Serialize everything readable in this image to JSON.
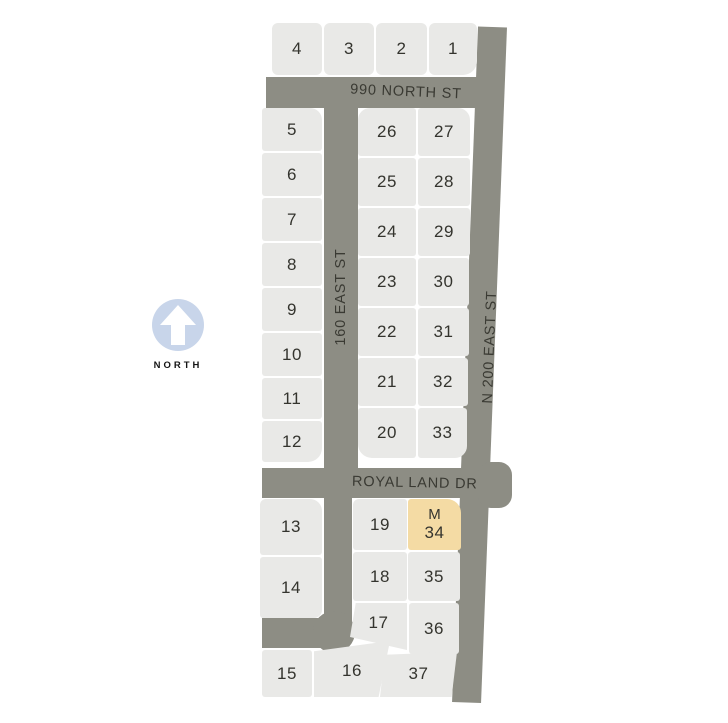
{
  "map": {
    "north_indicator": {
      "label": "NORTH"
    },
    "streets": {
      "north_990": {
        "name": "990 NORTH ST"
      },
      "east_160": {
        "name": "160 EAST ST"
      },
      "east_200": {
        "name": "N 200 EAST ST"
      },
      "royal_land": {
        "name": "ROYAL LAND DR"
      }
    },
    "highlighted_lot": {
      "number": "34",
      "marker": "M"
    },
    "lots": {
      "l1": {
        "number": "1"
      },
      "l2": {
        "number": "2"
      },
      "l3": {
        "number": "3"
      },
      "l4": {
        "number": "4"
      },
      "l5": {
        "number": "5"
      },
      "l6": {
        "number": "6"
      },
      "l7": {
        "number": "7"
      },
      "l8": {
        "number": "8"
      },
      "l9": {
        "number": "9"
      },
      "l10": {
        "number": "10"
      },
      "l11": {
        "number": "11"
      },
      "l12": {
        "number": "12"
      },
      "l13": {
        "number": "13"
      },
      "l14": {
        "number": "14"
      },
      "l15": {
        "number": "15"
      },
      "l16": {
        "number": "16"
      },
      "l17": {
        "number": "17"
      },
      "l18": {
        "number": "18"
      },
      "l19": {
        "number": "19"
      },
      "l20": {
        "number": "20"
      },
      "l21": {
        "number": "21"
      },
      "l22": {
        "number": "22"
      },
      "l23": {
        "number": "23"
      },
      "l24": {
        "number": "24"
      },
      "l25": {
        "number": "25"
      },
      "l26": {
        "number": "26"
      },
      "l27": {
        "number": "27"
      },
      "l28": {
        "number": "28"
      },
      "l29": {
        "number": "29"
      },
      "l30": {
        "number": "30"
      },
      "l31": {
        "number": "31"
      },
      "l32": {
        "number": "32"
      },
      "l33": {
        "number": "33"
      },
      "l34": {
        "number": "34",
        "marker": "M"
      },
      "l35": {
        "number": "35"
      },
      "l36": {
        "number": "36"
      },
      "l37": {
        "number": "37"
      }
    },
    "colors": {
      "street": "#8d8d84",
      "lot_fill": "#e9e9e7",
      "highlight_fill": "#f4dba4",
      "north_badge": "#c8d5ea"
    }
  }
}
